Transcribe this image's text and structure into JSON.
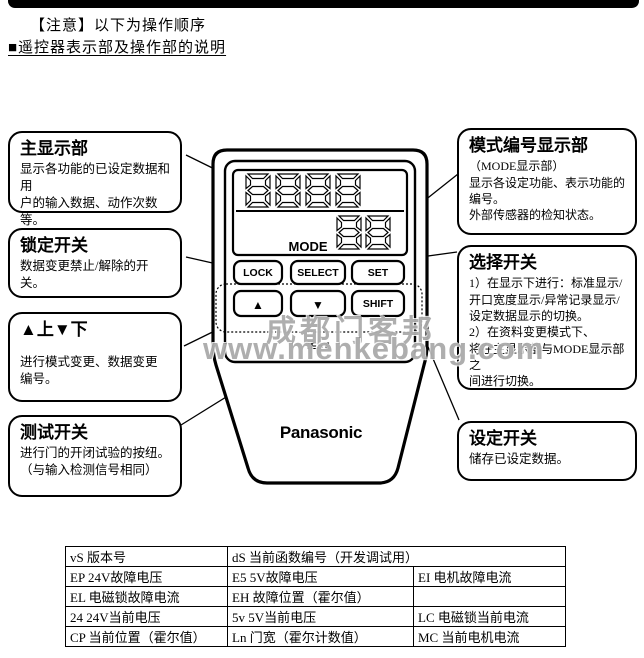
{
  "header": {
    "notice": "【注意】以下为操作顺序",
    "section_title": "■遥控器表示部及操作部的说明"
  },
  "remote": {
    "brand": "Panasonic",
    "mode_label": "MODE",
    "buttons": {
      "lock": "LOCK",
      "select": "SELECT",
      "set": "SET",
      "up": "▲",
      "down": "▼",
      "shift": "SHIFT",
      "test": "TEST"
    }
  },
  "callouts": {
    "main_display": {
      "title": "主显示部",
      "body": "显示各功能的已设定数据和用\n户的输入数据、动作次数等。"
    },
    "lock_switch": {
      "title": "锁定开关",
      "body": "数据变更禁止/解除的开关。"
    },
    "up_down": {
      "title": "▲上▼下",
      "body": "进行模式变更、数据变更\n编号。"
    },
    "test_switch": {
      "title": "测试开关",
      "body": "进行门的开闭试验的按纽。\n（与输入检测信号相同）"
    },
    "mode_display": {
      "title": "模式编号显示部",
      "body": "（MODE显示部）\n显示各设定功能、表示功能的\n编号。\n外部传感器的检知状态。"
    },
    "select_switch": {
      "title": "选择开关",
      "body": "1）在显示下进行：标准显示/\n开口宽度显示/异常记录显示/\n设定数据显示的切换。\n2）在资料变更模式下、\n将在主显示部与MODE显示部之\n间进行切换。"
    },
    "set_switch": {
      "title": "设定开关",
      "body": "储存已设定数据。"
    }
  },
  "watermark": {
    "line1": "成都门客邦",
    "line2": "www.menkebang.com"
  },
  "table": {
    "rows": [
      [
        {
          "text": "vS 版本号"
        },
        {
          "text": "dS 当前函数编号（开发调试用）"
        }
      ],
      [
        {
          "text": "EP 24V故障电压"
        },
        {
          "text": "E5 5V故障电压"
        },
        {
          "text": "EI 电机故障电流"
        }
      ],
      [
        {
          "text": "EL 电磁锁故障电流"
        },
        {
          "text": "EH 故障位置（霍尔值）"
        },
        {
          "text": ""
        }
      ],
      [
        {
          "text": "24 24V当前电压"
        },
        {
          "text": "5v 5V当前电压"
        },
        {
          "text": "LC 电磁锁当前电流"
        }
      ],
      [
        {
          "text": "CP 当前位置（霍尔值）"
        },
        {
          "text": "Ln 门宽（霍尔计数值）"
        },
        {
          "text": "MC 当前电机电流"
        }
      ]
    ]
  },
  "colors": {
    "ink": "#000000",
    "paper": "#ffffff",
    "watermark": "#7d7d7d"
  }
}
